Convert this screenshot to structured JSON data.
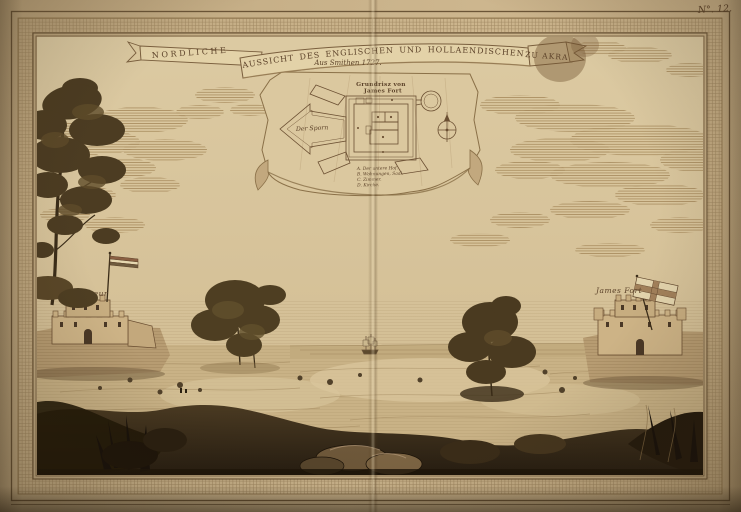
{
  "artwork": {
    "plate_number": "N°. 12.",
    "banner": {
      "left_word": "NORDLICHE",
      "main_title": "AUSSICHT DES ENGLISCHEN UND HOLLAENDISCHEN FORTS",
      "right_word": "ZU AKRA",
      "subtitle": "Aus Smithen 1727."
    },
    "plan": {
      "title_line1": "Grundrisz von",
      "title_line2": "James Fort",
      "spur_label": "Der Sporn",
      "legend": [
        "A. Der untere Hof.",
        "B. Wohnungen, Saal.",
        "C. Zimmer.",
        "D. Kirche."
      ]
    },
    "labels": {
      "left_fort": "Creveceur",
      "right_fort": "James Fort"
    },
    "colors": {
      "paper_margin": "#c7b088",
      "border_band": "#b59c74",
      "sky": "#d8c49a",
      "cloud_hatch": "#a88c5e",
      "ink": "#6b4f32",
      "dark_foliage": "#43351d",
      "foreground_dark": "#241b0e"
    }
  }
}
